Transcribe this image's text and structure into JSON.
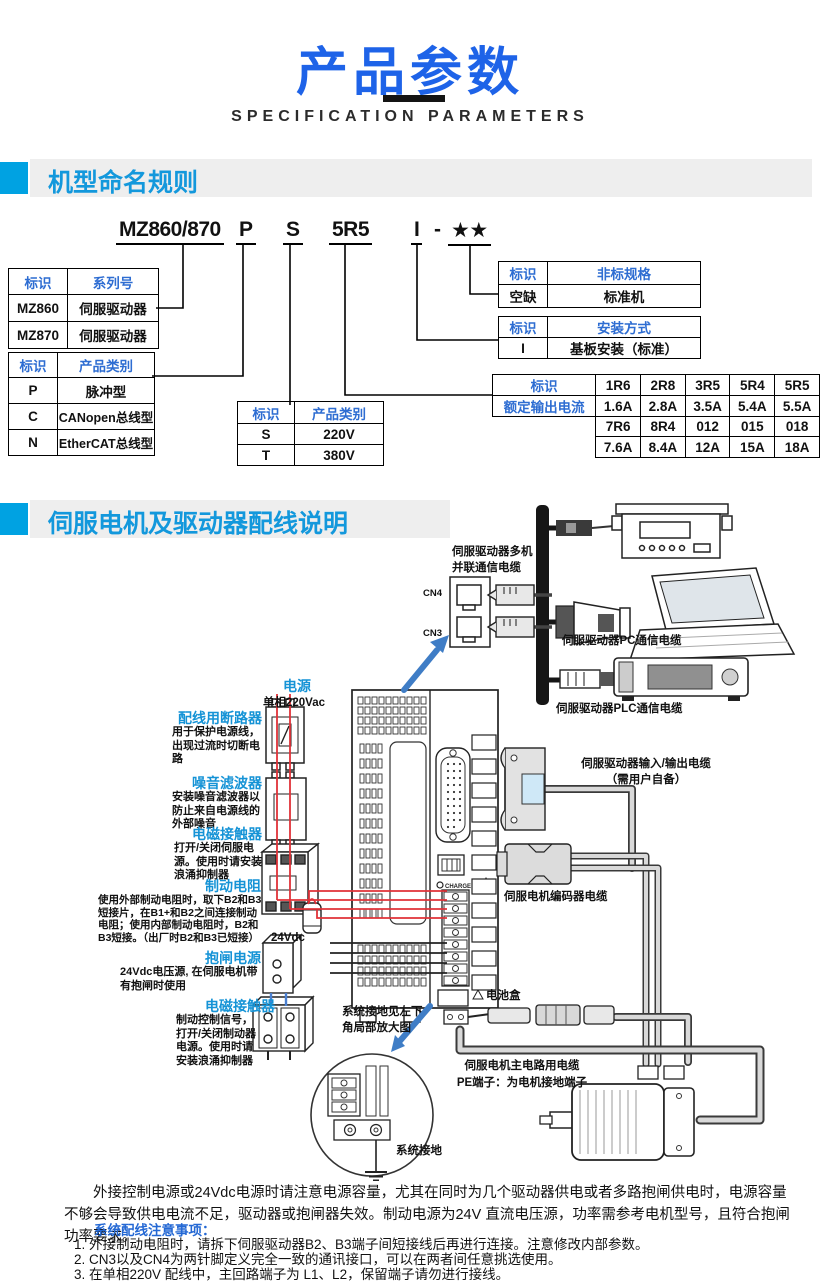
{
  "header": {
    "title": "产品参数",
    "subtitle": "SPECIFICATION PARAMETERS"
  },
  "colors": {
    "title_blue": "#1e63e8",
    "section_blue": "#00a2e2",
    "section_text_blue": "#1398dc",
    "table_header_blue": "#2e6dd2",
    "label_blue": "#1593d6",
    "wire_red": "#e03238",
    "arrow_blue": "#3f7dc6"
  },
  "naming": {
    "heading": "机型命名规则",
    "model": {
      "segments": [
        "MZ860/870",
        "P",
        "S",
        "5R5",
        "I",
        "-",
        "★★"
      ]
    },
    "series_table": {
      "headers": [
        "标识",
        "系列号"
      ],
      "rows": [
        [
          "MZ860",
          "伺服驱动器"
        ],
        [
          "MZ870",
          "伺服驱动器"
        ]
      ]
    },
    "type_table": {
      "headers": [
        "标识",
        "产品类别"
      ],
      "rows": [
        [
          "P",
          "脉冲型"
        ],
        [
          "C",
          "CANopen总线型"
        ],
        [
          "N",
          "EtherCAT总线型"
        ]
      ]
    },
    "voltage_table": {
      "headers": [
        "标识",
        "产品类别"
      ],
      "rows": [
        [
          "S",
          "220V"
        ],
        [
          "T",
          "380V"
        ]
      ]
    },
    "nonstd_table": {
      "headers": [
        "标识",
        "非标规格"
      ],
      "rows": [
        [
          "空缺",
          "标准机"
        ]
      ]
    },
    "mount_table": {
      "headers": [
        "标识",
        "安装方式"
      ],
      "rows": [
        [
          "I",
          "基板安装（标准）"
        ]
      ]
    },
    "current_table": {
      "label_header": "标识",
      "label_row": "额定输出电流",
      "group1_codes": [
        "1R6",
        "2R8",
        "3R5",
        "5R4",
        "5R5"
      ],
      "group1_values": [
        "1.6A",
        "2.8A",
        "3.5A",
        "5.4A",
        "5.5A"
      ],
      "group2_codes": [
        "7R6",
        "8R4",
        "012",
        "015",
        "018"
      ],
      "group2_values": [
        "7.6A",
        "8.4A",
        "12A",
        "15A",
        "18A"
      ]
    }
  },
  "wiring": {
    "heading": "伺服电机及驱动器配线说明",
    "multi_cable_label_1": "伺服驱动器多机",
    "multi_cable_label_2": "并联通信电缆",
    "cn4": "CN4",
    "cn3": "CN3",
    "pc_cable_label": "伺服驱动器PC通信电缆",
    "plc_cable_label": "伺服驱动器PLC通信电缆",
    "power_title": "电源",
    "power_sub": "单相220Vac",
    "breaker_title": "配线用断路器",
    "breaker_desc": "用于保护电源线，出现过流时切断电路",
    "filter_title": "噪音滤波器",
    "filter_desc": "安装噪音滤波器以防止来自电源线的外部噪音",
    "contactor_title": "电磁接触器",
    "contactor_desc": "打开/关闭伺服电源。使用时请安装浪涌抑制器",
    "brake_res_title": "制动电阻",
    "brake_res_desc": "使用外部制动电阻时，取下B2和B3短接片，在B1+和B2之间连接制动电阻；使用内部制动电阻时，B2和B3短接。（出厂时B2和B3已短接）",
    "v24_label": "24Vdc",
    "brake_pwr_title": "抱闸电源",
    "brake_pwr_desc": "24Vdc电压源, 在伺服电机带有抱闸时使用",
    "contactor2_title": "电磁接触器",
    "contactor2_desc": "制动控制信号，打开/关闭制动器电源。使用时请安装浪涌抑制器",
    "io_cable_label_1": "伺服驱动器输入/输出电缆",
    "io_cable_label_2": "（需用户自备）",
    "encoder_cable_label": "伺服电机编码器电缆",
    "battery_label": "电池盒",
    "ground_note_1": "系统接地见左下",
    "ground_note_2": "角局部放大图",
    "main_cable_label_1": "伺服电机主电路用电缆",
    "main_cable_label_2": "PE端子：为电机接地端子",
    "sys_ground_label": "系统接地",
    "charge_label": "CHARGE"
  },
  "notes": {
    "para": "外接控制电源或24Vdc电源时请注意电源容量，尤其在同时为几个驱动器供电或者多路抱闸供电时，电源容量不够会导致供电电流不足，驱动器或抱闸器失效。制动电源为24V 直流电压源，功率需参考电机型号，且符合抱闸功率要求。",
    "heading": "系统配线注意事项：",
    "item1": "1. 外接制动电阻时，请拆下伺服驱动器B2、B3端子间短接线后再进行连接。注意修改内部参数。",
    "item2": "2. CN3以及CN4为两针脚定义完全一致的通讯接口，可以在两者间任意挑选使用。",
    "item3": "3. 在单相220V 配线中，主回路端子为 L1、L2，保留端子请勿进行接线。"
  }
}
